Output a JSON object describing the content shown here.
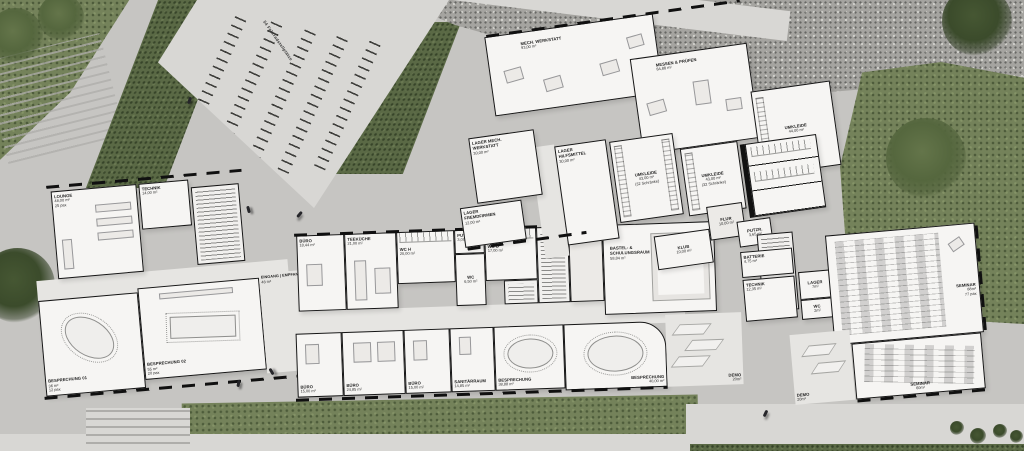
{
  "site": {
    "bike_path_label": "54 Fahrradstellplätze"
  },
  "colors": {
    "grass": "#74825A",
    "grass_dark": "#5A6945",
    "concrete": "#C6C5C2",
    "concrete_light": "#D8D7D4",
    "gravel": "#A5A4A0",
    "floor_white": "#F6F5F3",
    "corridor_grey": "#E6E5E2",
    "wall_black": "#161616"
  },
  "rooms": [
    {
      "name": "LOUNGE",
      "area": "48,00 m²",
      "note": "25 pax"
    },
    {
      "name": "TECHNIK",
      "area": "14,00 m²"
    },
    {
      "name": "BESPRECHUNG 01",
      "area": "36 m²",
      "note": "12 pax"
    },
    {
      "name": "BESPRECHUNG 02",
      "area": "55 m²",
      "note": "20 pax"
    },
    {
      "name": "EINGANG | EMPFANG",
      "area": "48 m²"
    },
    {
      "name": "BÜRO",
      "area": "18,44 m²"
    },
    {
      "name": "TEEKÜCHE",
      "area": "21,00 m²"
    },
    {
      "name": "WC H",
      "area": "20,00 m²"
    },
    {
      "name": "PUTZR.",
      "area": "3,00 m²"
    },
    {
      "name": "WC",
      "area": "6,50 m²"
    },
    {
      "name": "WC D",
      "area": "17,00 m²"
    },
    {
      "name": "FLUR",
      "area": "14,00 m²"
    },
    {
      "name": "BASTEL- & SCHULUNGSRAUM",
      "area": "58,84 m²"
    },
    {
      "name": "BÜRO",
      "area": "15,00 m²"
    },
    {
      "name": "BÜRO",
      "area": "24,85 m²"
    },
    {
      "name": "BÜRO",
      "area": "15,00 m²"
    },
    {
      "name": "SANITÄRRAUM",
      "area": "14,85 m²"
    },
    {
      "name": "BESPRECHUNG",
      "area": "38,88 m²"
    },
    {
      "name": "BESPRECHUNG",
      "area": "40,00 m²"
    },
    {
      "name": "DEMO",
      "area": "20m²"
    },
    {
      "name": "MECH. WERKSTATT",
      "area": "93,00 m²"
    },
    {
      "name": "MESSEN & PRÜFEN",
      "area": "84,88 m²"
    },
    {
      "name": "UMKLEIDE",
      "area": "44,00 m²"
    },
    {
      "name": "LAGER MECH. WERKSTATT",
      "area": "30,00 m²"
    },
    {
      "name": "LAGER FREMDFIRMEN",
      "area": "12,00 m²"
    },
    {
      "name": "LAGER HILFSMITTEL",
      "area": "30,00 m²"
    },
    {
      "name": "UMKLEIDE",
      "area": "43,00 m²",
      "note": "(32 Schränke)"
    },
    {
      "name": "UMKLEIDE",
      "area": "43,00 m²",
      "note": "(32 Schränke)"
    },
    {
      "name": "KLUB",
      "area": "10,00 m²"
    },
    {
      "name": "FLUR",
      "area": "10,00 m²"
    },
    {
      "name": "PUTZR.",
      "area": "3,65 m²"
    },
    {
      "name": "BATTERIE",
      "area": "4,75 m²"
    },
    {
      "name": "TECHNIK",
      "area": "12,35 m²"
    },
    {
      "name": "LAGER",
      "area": "7m²"
    },
    {
      "name": "WC",
      "area": "2m²"
    },
    {
      "name": "SEMINAR",
      "area": "88m²",
      "note": "77 pax"
    },
    {
      "name": "SEMINAR",
      "area": "60m²"
    },
    {
      "name": "DEMO",
      "area": "20m²"
    }
  ]
}
